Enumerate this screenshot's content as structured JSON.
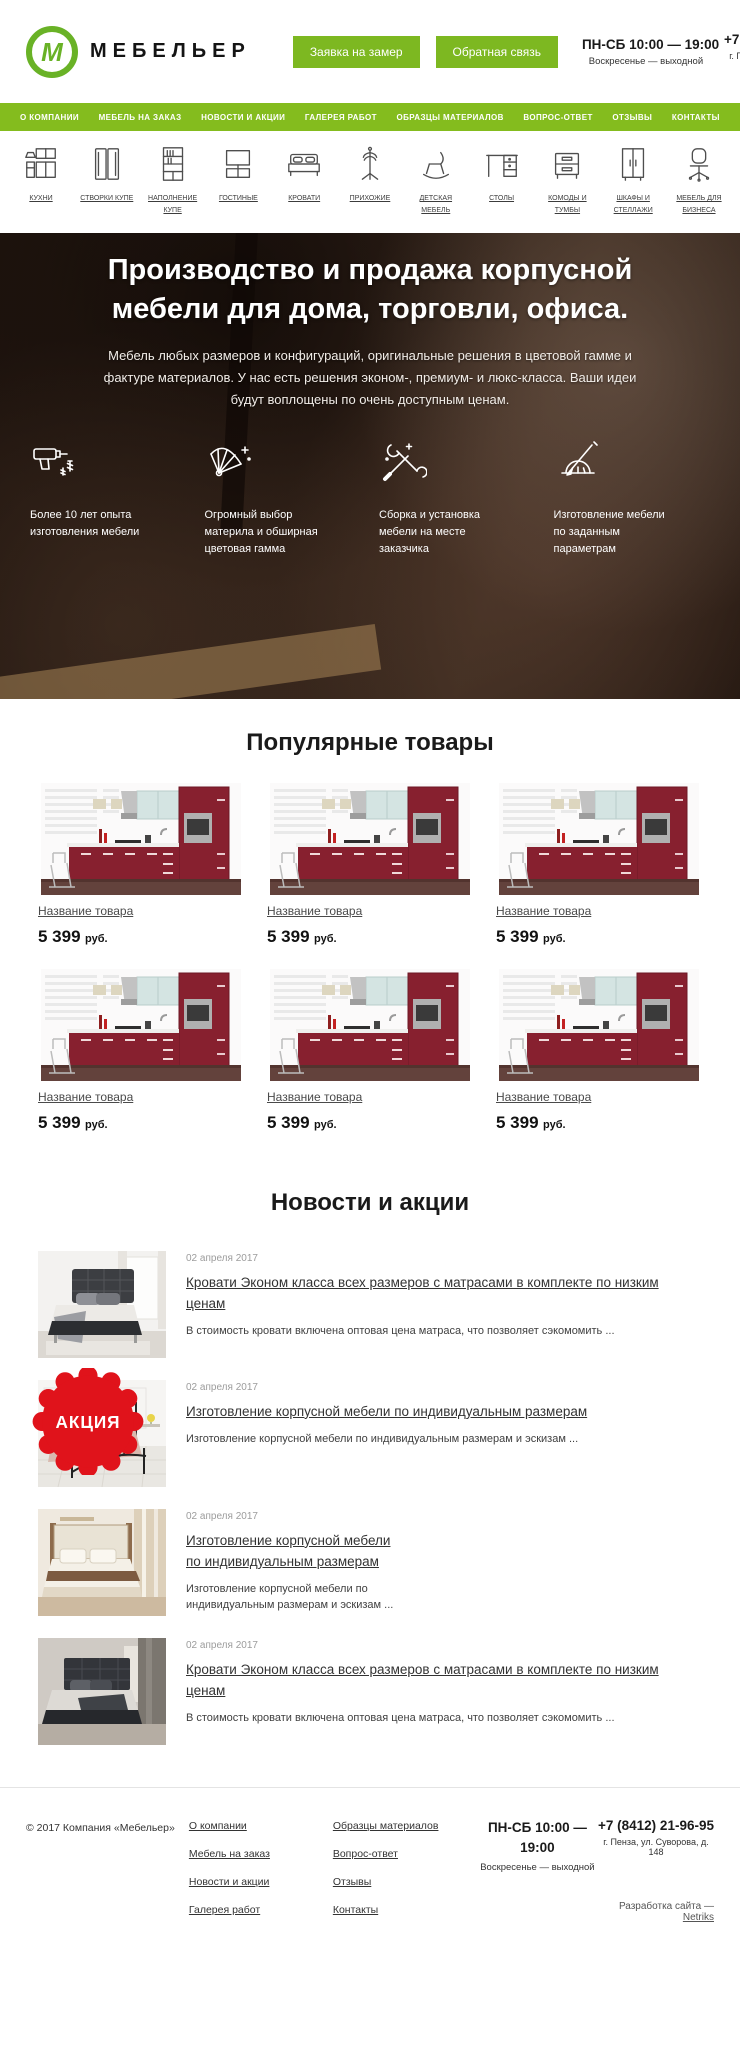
{
  "colors": {
    "accent": "#7db821",
    "badge_red": "#e0131b",
    "kitchen_red": "#87202f"
  },
  "header": {
    "logo_letter": "М",
    "logo_text": "МЕБЕЛЬЕР",
    "request_button": "Заявка на замер",
    "feedback_button": "Обратная связь",
    "hours": "ПН-СБ 10:00 — 19:00",
    "hours_note": "Воскресенье — выходной",
    "phone": "+7 (8412) 21-96-95",
    "address": "г. Пенза, ул. Суворова, д. 148"
  },
  "nav": {
    "items": [
      "О КОМПАНИИ",
      "МЕБЕЛЬ НА ЗАКАЗ",
      "НОВОСТИ И АКЦИИ",
      "ГАЛЕРЕЯ РАБОТ",
      "ОБРАЗЦЫ МАТЕРИАЛОВ",
      "ВОПРОС-ОТВЕТ",
      "ОТЗЫВЫ",
      "КОНТАКТЫ"
    ]
  },
  "categories": {
    "items": [
      {
        "label": "КУХНИ",
        "icon": "kitchen-icon"
      },
      {
        "label": "СТВОРКИ КУПЕ",
        "icon": "sliding-doors-icon"
      },
      {
        "label": "НАПОЛНЕНИЕ КУПЕ",
        "icon": "shelving-icon"
      },
      {
        "label": "ГОСТИНЫЕ",
        "icon": "tv-stand-icon"
      },
      {
        "label": "КРОВАТИ",
        "icon": "bed-icon"
      },
      {
        "label": "ПРИХОЖИЕ",
        "icon": "coat-rack-icon"
      },
      {
        "label": "ДЕТСКАЯ МЕБЕЛЬ",
        "icon": "rocking-toy-icon"
      },
      {
        "label": "СТОЛЫ",
        "icon": "desk-icon"
      },
      {
        "label": "КОМОДЫ И ТУМБЫ",
        "icon": "dresser-icon"
      },
      {
        "label": "ШКАФЫ И СТЕЛЛАЖИ",
        "icon": "wardrobe-icon"
      },
      {
        "label": "МЕБЕЛЬ ДЛЯ БИЗНЕСА",
        "icon": "office-chair-icon"
      }
    ]
  },
  "hero": {
    "title": "Производство и продажа корпусной мебели для дома, торговли, офиса.",
    "subtitle": "Мебель любых размеров и конфигураций, оригинальные решения в цветовой гамме и фактуре материалов. У нас есть решения эконом-, премиум- и люкс-класса. Ваши идеи будут воплощены по очень доступным ценам.",
    "features": [
      {
        "icon": "drill-icon",
        "text": "Более 10 лет опыта изготовления мебели"
      },
      {
        "icon": "color-swatches-icon",
        "text": "Огромный выбор материла и обширная цветовая гамма"
      },
      {
        "icon": "tools-icon",
        "text": "Сборка и установка мебели на месте заказчика"
      },
      {
        "icon": "drafting-icon",
        "text": "Изготовление мебели по заданным параметрам"
      }
    ]
  },
  "products": {
    "title": "Популярные товары",
    "items": [
      {
        "name": "Название товара",
        "price": "5 399",
        "currency": "руб."
      },
      {
        "name": "Название товара",
        "price": "5 399",
        "currency": "руб."
      },
      {
        "name": "Название товара",
        "price": "5 399",
        "currency": "руб."
      },
      {
        "name": "Название товара",
        "price": "5 399",
        "currency": "руб."
      },
      {
        "name": "Название товара",
        "price": "5 399",
        "currency": "руб."
      },
      {
        "name": "Название товара",
        "price": "5 399",
        "currency": "руб."
      }
    ]
  },
  "news": {
    "title": "Новости и акции",
    "badge": "АКЦИЯ",
    "items": [
      {
        "date": "02 апреля 2017",
        "title": "Кровати Эконом класса всех размеров с матрасами в комплекте по низким ценам",
        "text": "В стоимость кровати включена оптовая цена матраса, что позволяет сэкомомить ..."
      },
      {
        "date": "02 апреля 2017",
        "title": "Изготовление корпусной мебели по индивидуальным размерам",
        "text": "Изготовление корпусной мебели по индивидуальным размерам и эскизам ..."
      },
      {
        "date": "02 апреля 2017",
        "title": "Изготовление корпусной мебели по индивидуальным размерам",
        "text": "Изготовление корпусной мебели по индивидуальным размерам и эскизам ..."
      },
      {
        "date": "02 апреля 2017",
        "title": "Кровати Эконом класса всех размеров с матрасами в комплекте по низким ценам",
        "text": "В стоимость кровати включена оптовая цена матраса, что позволяет сэкомомить ..."
      }
    ]
  },
  "footer": {
    "copyright": "© 2017 Компания «Мебельер»",
    "links_col1": [
      "О компании",
      "Мебель на заказ",
      "Новости и акции",
      "Галерея работ"
    ],
    "links_col2": [
      "Образцы материалов",
      "Вопрос-ответ",
      "Отзывы",
      "Контакты"
    ],
    "hours": "ПН-СБ 10:00 — 19:00",
    "hours_note": "Воскресенье — выходной",
    "phone": "+7 (8412) 21-96-95",
    "address": "г. Пенза, ул. Суворова, д. 148",
    "credits_prefix": "Разработка сайта — ",
    "credits_link": "Netriks"
  }
}
